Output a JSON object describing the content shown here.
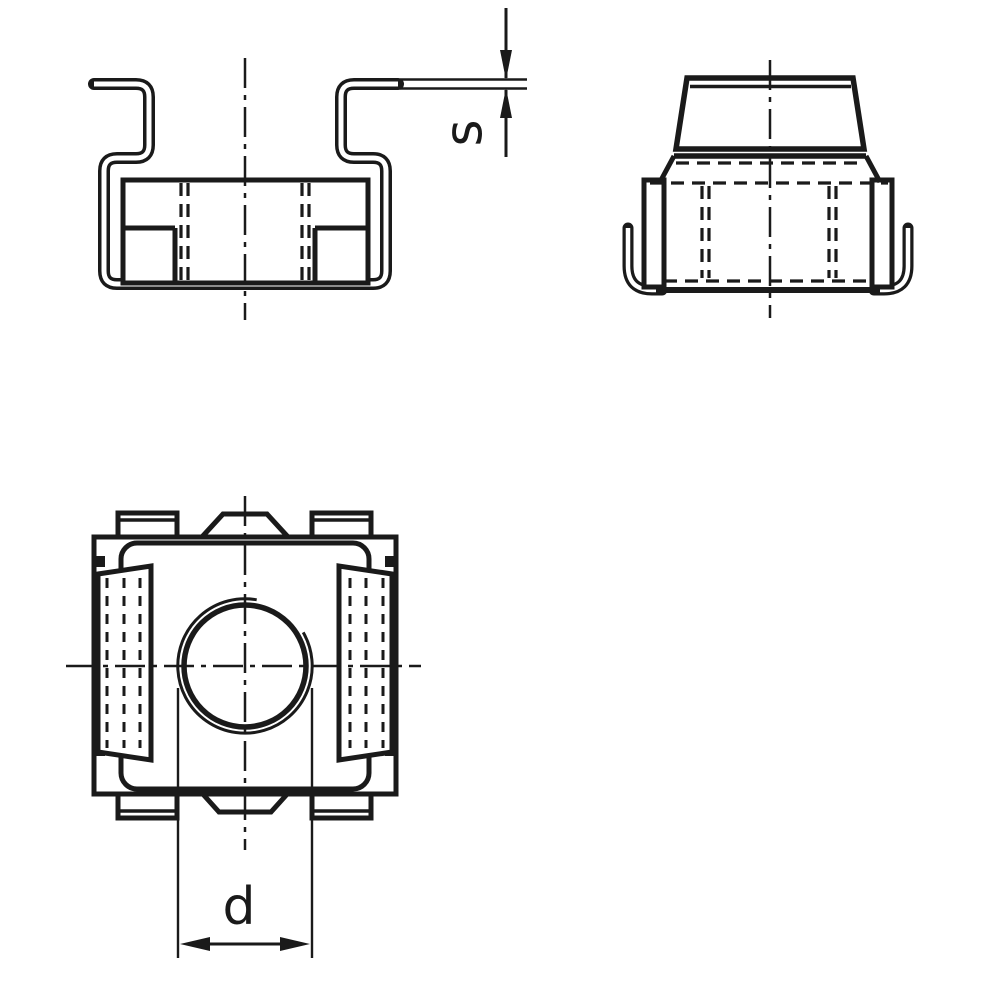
{
  "drawing": {
    "labels": {
      "sheet_thickness": "s",
      "thread_diameter": "d"
    },
    "colors": {
      "line": "#1a1a1a",
      "background": "#ffffff"
    }
  }
}
